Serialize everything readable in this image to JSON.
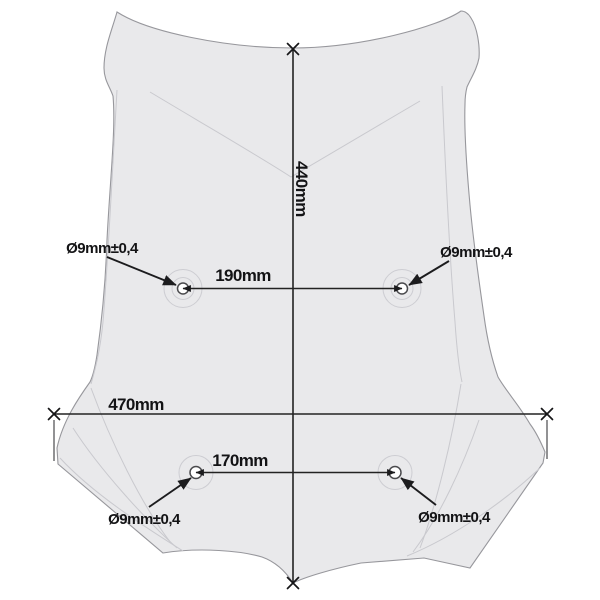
{
  "drawing": {
    "kind": "technical-dimension-drawing",
    "subject": "motorcycle windscreen with mounting holes",
    "labels": {
      "height": "440mm",
      "width": "470mm",
      "top_holes_distance": "190mm",
      "bottom_holes_distance": "170mm"
    },
    "holes": {
      "top_left": "Ø9mm±0,4",
      "top_right": "Ø9mm±0,4",
      "bottom_left": "Ø9mm±0,4",
      "bottom_right": "Ø9mm±0,4"
    },
    "colors": {
      "background": "#ffffff",
      "screen_fill": "#e9e9eb",
      "screen_outline": "#97979c",
      "contour_line": "#c9c9ce",
      "dimension_ink": "#1c1c1e"
    }
  }
}
